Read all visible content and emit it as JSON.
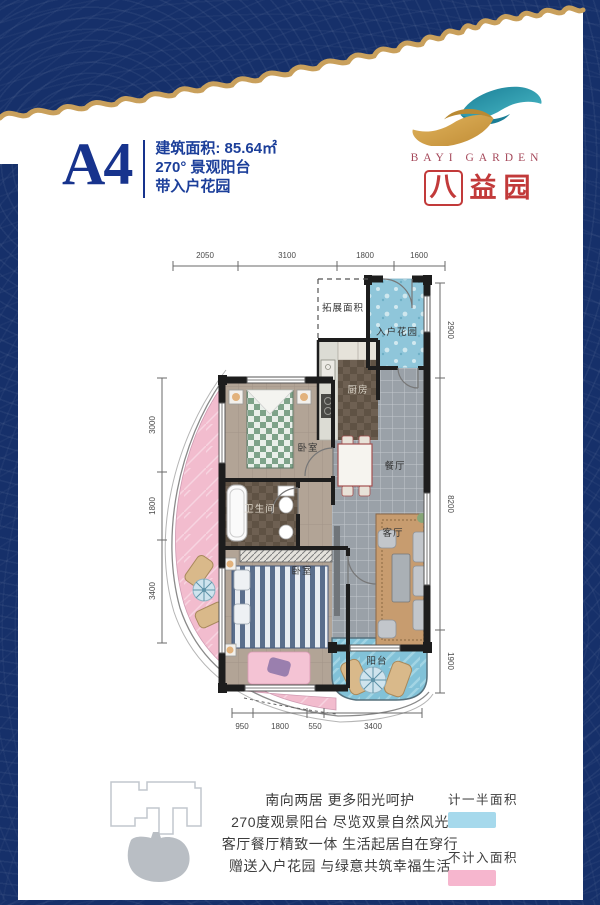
{
  "brand": {
    "name_en": "BAYI GARDEN",
    "cn_char1": "八",
    "cn_char2": "益",
    "cn_char3": "园"
  },
  "unit": {
    "code": "A4",
    "area": "建筑面积: 85.64㎡",
    "feature_line1": "270° 景观阳台",
    "feature_line2": "带入户花园"
  },
  "floorplan": {
    "rooms": {
      "expand": "拓展面积",
      "entry_garden": "入户花园",
      "kitchen": "厨房",
      "dining": "餐厅",
      "living": "客厅",
      "bedroom_top": "卧室",
      "bathroom": "卫生间",
      "bedroom_main": "卧室",
      "balcony": "阳台"
    },
    "dims": {
      "top": [
        "2050",
        "3100",
        "1800",
        "1600"
      ],
      "left": [
        "3000",
        "1800",
        "3400"
      ],
      "right": [
        "2900",
        "8200",
        "1900"
      ],
      "bottom": [
        "950",
        "1800",
        "550",
        "3400"
      ]
    }
  },
  "legend": {
    "items": [
      {
        "label": "计一半面积",
        "color": "#a6d9ec"
      },
      {
        "label": "不计入面积",
        "color": "#f6b6ce"
      }
    ]
  },
  "marketing": {
    "lines": [
      "南向两居 更多阳光呵护",
      "270度观景阳台 尽览双景自然风光",
      "客厅餐厅精致一体 生活起居自在穿行",
      "赠送入户花园 与绿意共筑幸福生活"
    ]
  }
}
